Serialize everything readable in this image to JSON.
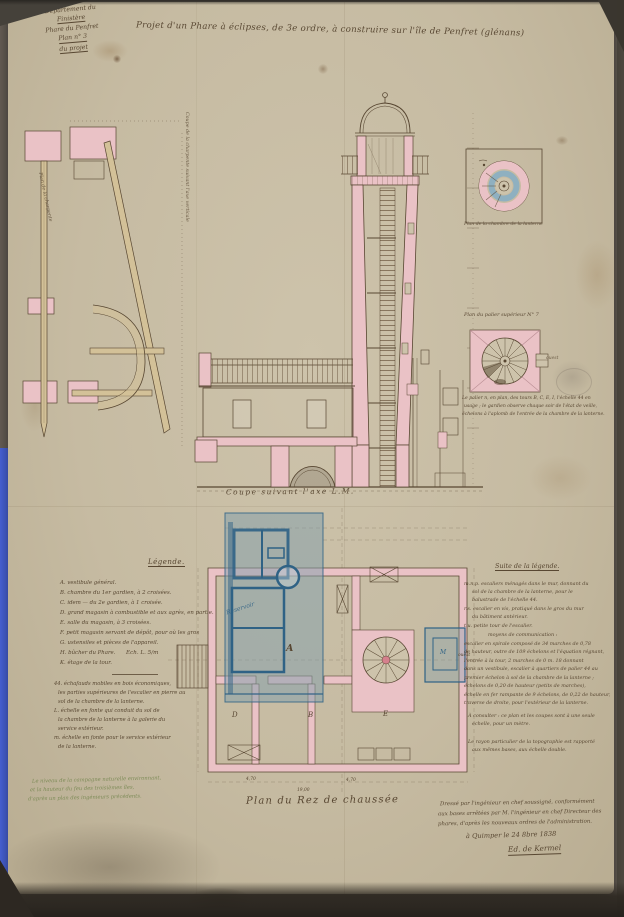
{
  "colors": {
    "ink": "#584732",
    "pink": "#eac2c6",
    "pink_dark": "#d5808d",
    "blue_wash": "#7f9eac",
    "blue_line": "#2f6285",
    "buff": "#d3c198",
    "green_ink": "#7d8b57",
    "paper": "#c8bda4",
    "blue_strip": "#4b67e2"
  },
  "stamp": {
    "lines": [
      "Département du",
      "Finistère",
      "Phare du Penfret",
      "Plan n° 3",
      "du projet"
    ]
  },
  "title": "Projet d'un Phare à éclipses, de 3e ordre, à construire sur l'île de Penfret (glénans)",
  "left_drawing": {
    "caption_inner": "Plan de la charpente",
    "caption_vertical": "Coupe de la charpente suivant l'axe verticale"
  },
  "tower": {
    "caption": "Coupe suivant l'axe L.M."
  },
  "lantern_detail": {
    "caption": "Plan de la chambre de la lanterne"
  },
  "landing_detail": {
    "caption": "Plan du palier supérieur N° 7",
    "word_right": "ouest",
    "note_lines": [
      "Le palier n, en plan, des tours B, C, E, I, l'échelle 44 en",
      "usage ; le gardien observe chaque soir de l'état de veille,",
      "échelons à l'aplomb de l'entrée de la chambre de la lanterne."
    ]
  },
  "ground_plan": {
    "caption": "Plan du Rez de chaussée",
    "scale_note": "Ech. L. 5/m",
    "flap_label": "Réservoir",
    "rooms": {
      "a": "A",
      "d": "D",
      "b": "B",
      "e": "E",
      "m": "M",
      "west": "ouest"
    },
    "dims": [
      "4,70",
      "4,70",
      "19,00"
    ]
  },
  "legend": {
    "heading": "Légende.",
    "items": [
      "A. vestibule général.",
      "B. chambre du 1er gardien, à 2 croisées.",
      "C. idem — du 2e gardien, à 1 croisée.",
      "D. grand magasin à combustible et aux agrès, en partie.",
      "E. salle du magasin, à 3 croisées.",
      "F. petit magasin servant de dépôt, pour où les gros",
      "G. ustensiles et pièces de l'appareil.",
      "H. bûcher du Phare.",
      "K. étage de la tour."
    ],
    "extra_lines": [
      "44. échafauds mobiles en bois économiques,",
      "les parties supérieures de l'escalier en pierre au",
      "sol de la chambre de la lanterne.",
      "L. échelle en fonte qui conduit du sol de",
      "la chambre de la lanterne à la galerie du",
      "service extérieur.",
      "m. échelle en fonte pour le service extérieur",
      "de la lanterne."
    ],
    "green_note": [
      "Le niveau de la campagne naturelle environnant,",
      "et la hauteur du feu des troisièmes îles,",
      "d'après un plan des ingénieurs précédents."
    ]
  },
  "suite": {
    "heading": "Suite de la légende.",
    "lines": [
      "m.n.p. escaliers ménagés dans le mur, donnant du",
      "sol de la chambre de la lanterne, pour le",
      "balustrade de l'échelle 44.",
      "r.s. escalier en vis, pratiqué dans le gros du mur",
      "du bâtiment antérieur.",
      "t.u. petite tour de l'escalier.",
      "moyens de communication :",
      "escalier en spirale composé de 34 marches de 0,78",
      "de hauteur, outre de 109 échelons et l'équation régnant,",
      "l'entrée à la tour, 2 marches de 0 m. 18 donnant",
      "dans un vestibule, escalier à quartiers de palier 44 au",
      "premier échelon à sol de la chambre de la lanterne ;",
      "échelons de 0,20 de hauteur (petits de marches),",
      "échelle en fer rampante de 9 échelons, de 0,22 de hauteur,",
      "traverse de droite, pour l'extérieur de la lanterne."
    ],
    "post_lines": [
      "À consulter : ce plan et les coupes sont à une seule",
      "échelle, pour un mètre.",
      "Le rayon particulier de la topographie est rapporté",
      "aux mêmes bases, aux échelle double."
    ]
  },
  "signature": {
    "lines": [
      "Dressé par l'ingénieur en chef soussigné, conformément",
      "aux bases arrêtées par M. l'ingénieur en chef Directeur des",
      "phares, d'après les nouveaux ordres de l'administration."
    ],
    "dateline": "à Quimper le 24 8bre 1838",
    "name": "Ed. de Kermel"
  }
}
